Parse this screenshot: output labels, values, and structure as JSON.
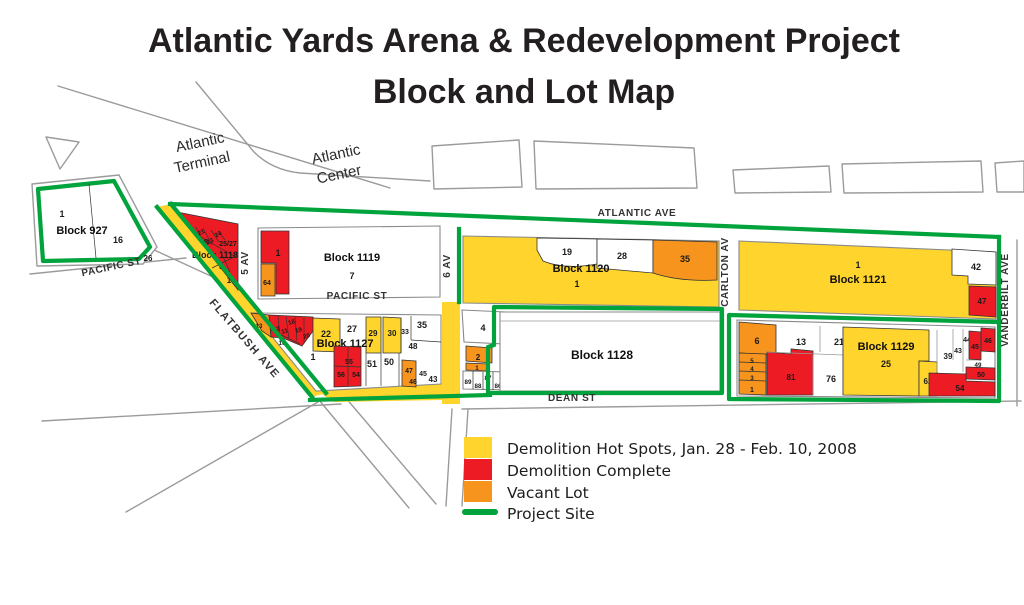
{
  "title": {
    "line1": "Atlantic Yards Arena & Redevelopment Project",
    "line2": "Block and Lot Map"
  },
  "colors": {
    "hotspot": "#FFD42C",
    "complete": "#ED1C24",
    "vacant": "#F7941E",
    "project": "#00A33C"
  },
  "legend": {
    "items": [
      {
        "key": "hotspot",
        "label": "Demolition Hot Spots, Jan. 28 - Feb. 10, 2008"
      },
      {
        "key": "complete",
        "label": "Demolition Complete"
      },
      {
        "key": "vacant",
        "label": "Vacant Lot"
      },
      {
        "key": "project",
        "label": "Project Site"
      }
    ]
  },
  "areas": {
    "terminal_line1": "Atlantic",
    "terminal_line2": "Terminal",
    "center_line1": "Atlantic",
    "center_line2": "Center"
  },
  "streets": {
    "atlantic": "ATLANTIC AVE",
    "pacific": "PACIFIC ST",
    "flatbush": "FLATBUSH AVE",
    "fifth": "5 AV",
    "sixth": "6 AV",
    "carlton": "CARLTON AV",
    "vanderbilt": "VANDERBILT AVE",
    "dean": "DEAN ST"
  },
  "blocks": {
    "b927": {
      "name": "Block 927",
      "lots": {
        "l1": {
          "label": "1",
          "status": "none"
        },
        "l16": {
          "label": "16",
          "status": "none"
        },
        "l26": {
          "label": "26",
          "status": "none"
        }
      }
    },
    "b1118": {
      "name": "Block 1118",
      "lots": {
        "l21": {
          "label": "21",
          "status": "complete"
        },
        "l23": {
          "label": "23",
          "status": "complete"
        },
        "l24": {
          "label": "24",
          "status": "complete"
        },
        "l25_27": {
          "label": "25/27",
          "status": "complete"
        },
        "l6": {
          "label": "6",
          "status": "complete"
        },
        "l5": {
          "label": "5",
          "status": "complete"
        },
        "l1": {
          "label": "1",
          "status": "complete"
        }
      }
    },
    "b1119": {
      "name": "Block 1119",
      "lots": {
        "l1": {
          "label": "1",
          "status": "complete"
        },
        "l64": {
          "label": "64",
          "status": "vacant"
        },
        "l7": {
          "label": "7",
          "status": "none"
        }
      }
    },
    "b1120": {
      "name": "Block 1120",
      "lots": {
        "l1": {
          "label": "1",
          "status": "hotspot"
        },
        "l19": {
          "label": "19",
          "status": "none"
        },
        "l28": {
          "label": "28",
          "status": "none"
        },
        "l35": {
          "label": "35",
          "status": "vacant"
        }
      }
    },
    "b1121": {
      "name": "Block 1121",
      "lots": {
        "l1": {
          "label": "1",
          "status": "hotspot"
        },
        "l42": {
          "label": "42",
          "status": "none"
        },
        "l47": {
          "label": "47",
          "status": "complete"
        }
      }
    },
    "b1127": {
      "name": "Block 1127",
      "lots": {
        "l13": {
          "label": "13",
          "status": "vacant"
        },
        "l12": {
          "label": "12",
          "status": "complete"
        },
        "l11": {
          "label": "11",
          "status": "complete"
        },
        "l10": {
          "label": "10",
          "status": "complete"
        },
        "l18": {
          "label": "18",
          "status": "complete"
        },
        "l19": {
          "label": "19",
          "status": "complete"
        },
        "l20": {
          "label": "20",
          "status": "complete"
        },
        "l21": {
          "label": "21",
          "status": "none"
        },
        "l22": {
          "label": "22",
          "status": "hotspot"
        },
        "l27": {
          "label": "27",
          "status": "none"
        },
        "l29": {
          "label": "29",
          "status": "hotspot"
        },
        "l30": {
          "label": "30",
          "status": "hotspot"
        },
        "l33": {
          "label": "33",
          "status": "none"
        },
        "l35": {
          "label": "35",
          "status": "none"
        },
        "l48": {
          "label": "48",
          "status": "none"
        },
        "l1": {
          "label": "1",
          "status": "none"
        },
        "l55": {
          "label": "55",
          "status": "complete"
        },
        "l56": {
          "label": "56",
          "status": "complete"
        },
        "l54": {
          "label": "54",
          "status": "complete"
        },
        "l51": {
          "label": "51",
          "status": "none"
        },
        "l50": {
          "label": "50",
          "status": "none"
        },
        "l47": {
          "label": "47",
          "status": "vacant"
        },
        "l46": {
          "label": "46",
          "status": "vacant"
        },
        "l45": {
          "label": "45",
          "status": "none"
        },
        "l43": {
          "label": "43",
          "status": "none"
        }
      }
    },
    "b1128": {
      "name": "Block 1128",
      "lots": {
        "l4": {
          "label": "4",
          "status": "none"
        },
        "l2": {
          "label": "2",
          "status": "vacant"
        },
        "l1": {
          "label": "1",
          "status": "vacant"
        },
        "l89": {
          "label": "89",
          "status": "none"
        },
        "l88": {
          "label": "88",
          "status": "none"
        },
        "l87": {
          "label": "87",
          "status": "none"
        },
        "l86": {
          "label": "86",
          "status": "none"
        },
        "l85": {
          "label": "85",
          "status": "none"
        }
      }
    },
    "b1129": {
      "name": "Block 1129",
      "lots": {
        "l6": {
          "label": "6",
          "status": "vacant"
        },
        "l5": {
          "label": "5",
          "status": "vacant"
        },
        "l4": {
          "label": "4",
          "status": "vacant"
        },
        "l3": {
          "label": "3",
          "status": "vacant"
        },
        "l1": {
          "label": "1",
          "status": "vacant"
        },
        "l81": {
          "label": "81",
          "status": "complete"
        },
        "l13": {
          "label": "13",
          "status": "none"
        },
        "l21": {
          "label": "21",
          "status": "none"
        },
        "l76": {
          "label": "76",
          "status": "none"
        },
        "l25": {
          "label": "25",
          "status": "hotspot"
        },
        "l62": {
          "label": "62",
          "status": "hotspot"
        },
        "l39": {
          "label": "39",
          "status": "none"
        },
        "l43": {
          "label": "43",
          "status": "none"
        },
        "l44": {
          "label": "44",
          "status": "none"
        },
        "l45": {
          "label": "45",
          "status": "complete"
        },
        "l46": {
          "label": "46",
          "status": "complete"
        },
        "l49": {
          "label": "49",
          "status": "none"
        },
        "l50": {
          "label": "50",
          "status": "complete"
        },
        "l54": {
          "label": "54",
          "status": "complete"
        }
      }
    }
  }
}
